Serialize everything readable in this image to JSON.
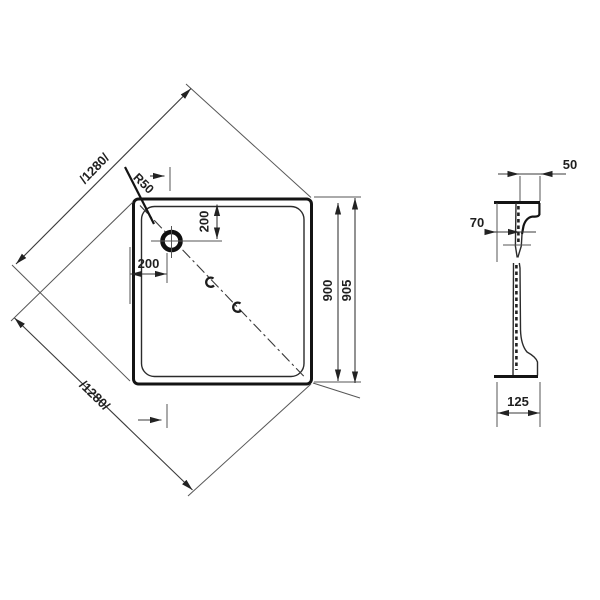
{
  "title": "Square shower tray technical drawing",
  "views": {
    "plan": {
      "labels": {
        "diagonal_top": "/1280/",
        "diagonal_bottom": "/1280/",
        "corner_radius": "R50",
        "drain_offset_top": "200",
        "drain_offset_left": "200",
        "outer_size": "900",
        "overall_size": "905"
      }
    },
    "section": {
      "labels": {
        "rim_width": "50",
        "rim_inset": "70",
        "base_depth": "125"
      }
    }
  },
  "colors": {
    "background": "#ffffff",
    "bold_line": "#141414",
    "thin_line": "#565656",
    "dim_line": "#3a3a3a"
  }
}
